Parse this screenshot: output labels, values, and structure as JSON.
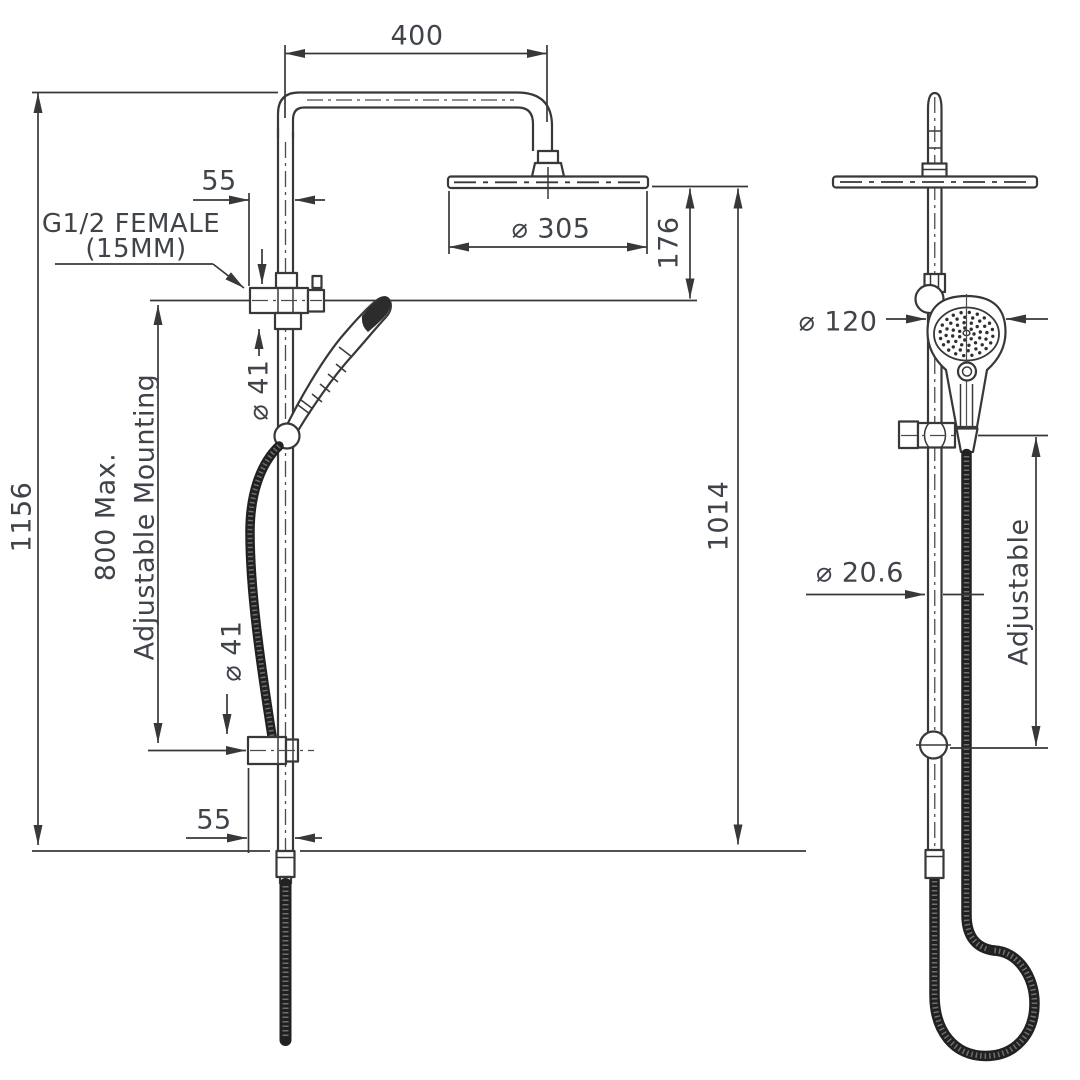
{
  "meta": {
    "background": "#ffffff",
    "line_color": "#383838",
    "text_color": "#3f434a",
    "hose_color": "#212121"
  },
  "front_view": {
    "dims": {
      "width_top": "400",
      "offset_top": "55",
      "inlet_line1": "G1/2 FEMALE",
      "inlet_line2": "(15MM)",
      "bracket_dia_upper": "⌀ 41",
      "overall_height": "1156",
      "mount_line1": "800 Max.",
      "mount_line2": "Adjustable Mounting",
      "head_dia": "⌀ 305",
      "head_drop": "176",
      "column_height": "1014",
      "bracket_dia_lower": "⌀ 41",
      "offset_bottom": "55"
    }
  },
  "side_view": {
    "dims": {
      "hand_shower_dia": "⌀ 120",
      "pipe_dia": "⌀ 20.6",
      "slider_range": "Adjustable"
    }
  }
}
